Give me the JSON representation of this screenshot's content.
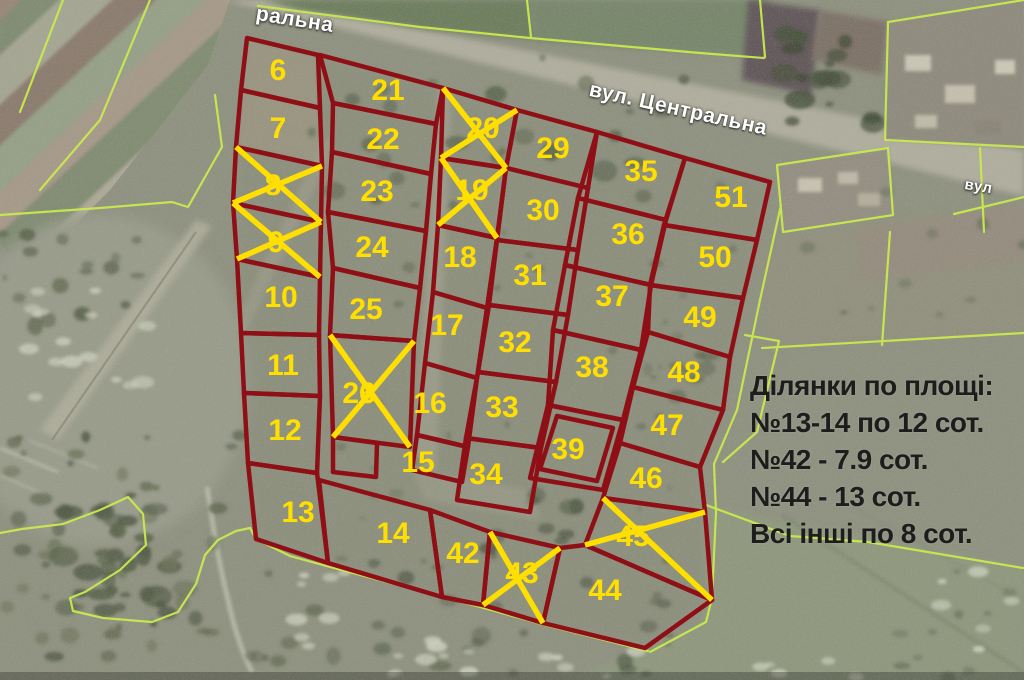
{
  "title": "Кадастровий план ділянок на супутниковому знімку",
  "colors": {
    "parcel_border": "#8e1016",
    "parcel_number": "#ffdf00",
    "sold_cross": "#ffdf00",
    "cadastral_line": "#c9e94f",
    "legend_text": "#1d1d1d",
    "street_label": "#ffffff"
  },
  "legend": {
    "title": "Ділянки по площі:",
    "lines": [
      "№13-14 по 12 сот.",
      "№42 - 7.9 сот.",
      "№44 - 13 сот.",
      "Всі інші по 8 сот."
    ]
  },
  "street_labels": {
    "central_full": "вул. Центральна",
    "central_partial_top": "ральна",
    "street_partial_right": "вул"
  },
  "sold_parcel_numbers": [
    "8",
    "9",
    "19",
    "20",
    "26",
    "43",
    "45"
  ],
  "parcels": [
    {
      "number": "6",
      "sold": false,
      "points": [
        [
          247,
          38
        ],
        [
          318,
          55
        ],
        [
          320,
          108
        ],
        [
          241,
          90
        ]
      ],
      "label": [
        278,
        70
      ]
    },
    {
      "number": "7",
      "sold": false,
      "points": [
        [
          241,
          90
        ],
        [
          320,
          108
        ],
        [
          322,
          166
        ],
        [
          236,
          147
        ]
      ],
      "label": [
        278,
        128
      ]
    },
    {
      "number": "8",
      "sold": true,
      "points": [
        [
          236,
          147
        ],
        [
          322,
          166
        ],
        [
          321,
          222
        ],
        [
          233,
          203
        ]
      ],
      "label": [
        273,
        185
      ]
    },
    {
      "number": "9",
      "sold": true,
      "points": [
        [
          233,
          203
        ],
        [
          321,
          222
        ],
        [
          320,
          277
        ],
        [
          237,
          259
        ]
      ],
      "label": [
        276,
        242
      ]
    },
    {
      "number": "10",
      "sold": false,
      "points": [
        [
          237,
          259
        ],
        [
          320,
          277
        ],
        [
          319,
          335
        ],
        [
          241,
          333
        ]
      ],
      "label": [
        281,
        297
      ]
    },
    {
      "number": "11",
      "sold": false,
      "points": [
        [
          241,
          333
        ],
        [
          319,
          335
        ],
        [
          320,
          396
        ],
        [
          244,
          393
        ]
      ],
      "label": [
        283,
        365
      ]
    },
    {
      "number": "12",
      "sold": false,
      "points": [
        [
          244,
          393
        ],
        [
          320,
          396
        ],
        [
          317,
          473
        ],
        [
          248,
          463
        ]
      ],
      "label": [
        285,
        430
      ]
    },
    {
      "number": "13",
      "sold": false,
      "points": [
        [
          248,
          463
        ],
        [
          317,
          473
        ],
        [
          328,
          563
        ],
        [
          256,
          539
        ]
      ],
      "label": [
        298,
        512
      ]
    },
    {
      "number": "21",
      "sold": false,
      "points": [
        [
          320,
          55
        ],
        [
          443,
          88
        ],
        [
          436,
          124
        ],
        [
          333,
          103
        ]
      ],
      "label": [
        388,
        90
      ]
    },
    {
      "number": "22",
      "sold": false,
      "points": [
        [
          333,
          103
        ],
        [
          436,
          124
        ],
        [
          431,
          174
        ],
        [
          332,
          152
        ]
      ],
      "label": [
        383,
        139
      ]
    },
    {
      "number": "23",
      "sold": false,
      "points": [
        [
          332,
          152
        ],
        [
          431,
          174
        ],
        [
          426,
          231
        ],
        [
          328,
          212
        ]
      ],
      "label": [
        377,
        191
      ]
    },
    {
      "number": "24",
      "sold": false,
      "points": [
        [
          328,
          212
        ],
        [
          426,
          231
        ],
        [
          420,
          288
        ],
        [
          333,
          268
        ]
      ],
      "label": [
        372,
        247
      ]
    },
    {
      "number": "25",
      "sold": false,
      "points": [
        [
          333,
          268
        ],
        [
          420,
          288
        ],
        [
          414,
          341
        ],
        [
          330,
          335
        ]
      ],
      "label": [
        366,
        309
      ]
    },
    {
      "number": "26",
      "sold": true,
      "points": [
        [
          330,
          335
        ],
        [
          414,
          341
        ],
        [
          410,
          447
        ],
        [
          333,
          437
        ]
      ],
      "label": [
        359,
        393
      ]
    },
    {
      "number": "",
      "sold": false,
      "points": [
        [
          333,
          437
        ],
        [
          377,
          443
        ],
        [
          376,
          477
        ],
        [
          333,
          472
        ]
      ],
      "label": null
    },
    {
      "number": "14",
      "sold": false,
      "points": [
        [
          319,
          480
        ],
        [
          430,
          510
        ],
        [
          442,
          597
        ],
        [
          328,
          563
        ]
      ],
      "label": [
        393,
        533
      ]
    },
    {
      "number": "20",
      "sold": true,
      "points": [
        [
          443,
          88
        ],
        [
          517,
          110
        ],
        [
          506,
          168
        ],
        [
          441,
          158
        ]
      ],
      "label": [
        483,
        128
      ]
    },
    {
      "number": "19",
      "sold": true,
      "points": [
        [
          441,
          158
        ],
        [
          506,
          168
        ],
        [
          497,
          238
        ],
        [
          438,
          225
        ]
      ],
      "label": [
        472,
        190
      ]
    },
    {
      "number": "18",
      "sold": false,
      "points": [
        [
          438,
          225
        ],
        [
          497,
          238
        ],
        [
          487,
          308
        ],
        [
          433,
          292
        ]
      ],
      "label": [
        460,
        257
      ]
    },
    {
      "number": "17",
      "sold": false,
      "points": [
        [
          433,
          292
        ],
        [
          487,
          308
        ],
        [
          477,
          378
        ],
        [
          425,
          363
        ]
      ],
      "label": [
        447,
        325
      ]
    },
    {
      "number": "16",
      "sold": false,
      "points": [
        [
          425,
          363
        ],
        [
          477,
          378
        ],
        [
          468,
          447
        ],
        [
          417,
          435
        ]
      ],
      "label": [
        430,
        403
      ]
    },
    {
      "number": "15",
      "sold": false,
      "points": [
        [
          417,
          435
        ],
        [
          468,
          447
        ],
        [
          462,
          482
        ],
        [
          412,
          470
        ]
      ],
      "label": [
        418,
        462
      ]
    },
    {
      "number": "42",
      "sold": false,
      "points": [
        [
          430,
          510
        ],
        [
          490,
          532
        ],
        [
          483,
          605
        ],
        [
          442,
          597
        ]
      ],
      "label": [
        463,
        553
      ]
    },
    {
      "number": "43",
      "sold": true,
      "points": [
        [
          490,
          532
        ],
        [
          560,
          548
        ],
        [
          543,
          623
        ],
        [
          483,
          605
        ]
      ],
      "label": [
        522,
        573
      ]
    },
    {
      "number": "29",
      "sold": false,
      "points": [
        [
          517,
          110
        ],
        [
          597,
          132
        ],
        [
          588,
          188
        ],
        [
          506,
          168
        ]
      ],
      "label": [
        553,
        148
      ]
    },
    {
      "number": "30",
      "sold": false,
      "points": [
        [
          506,
          168
        ],
        [
          588,
          188
        ],
        [
          578,
          250
        ],
        [
          497,
          240
        ]
      ],
      "label": [
        543,
        210
      ]
    },
    {
      "number": "31",
      "sold": false,
      "points": [
        [
          497,
          240
        ],
        [
          578,
          250
        ],
        [
          568,
          315
        ],
        [
          489,
          305
        ]
      ],
      "label": [
        530,
        275
      ]
    },
    {
      "number": "32",
      "sold": false,
      "points": [
        [
          489,
          305
        ],
        [
          568,
          315
        ],
        [
          556,
          382
        ],
        [
          478,
          372
        ]
      ],
      "label": [
        515,
        342
      ]
    },
    {
      "number": "33",
      "sold": false,
      "points": [
        [
          478,
          372
        ],
        [
          556,
          382
        ],
        [
          541,
          448
        ],
        [
          466,
          438
        ]
      ],
      "label": [
        502,
        407
      ]
    },
    {
      "number": "34",
      "sold": false,
      "points": [
        [
          466,
          438
        ],
        [
          541,
          448
        ],
        [
          530,
          512
        ],
        [
          457,
          500
        ]
      ],
      "label": [
        486,
        474
      ]
    },
    {
      "number": "44",
      "sold": false,
      "points": [
        [
          560,
          548
        ],
        [
          585,
          545
        ],
        [
          712,
          600
        ],
        [
          645,
          648
        ],
        [
          543,
          623
        ]
      ],
      "label": [
        605,
        590
      ]
    },
    {
      "number": "35",
      "sold": false,
      "points": [
        [
          597,
          132
        ],
        [
          685,
          158
        ],
        [
          666,
          220
        ],
        [
          578,
          198
        ]
      ],
      "label": [
        641,
        171
      ]
    },
    {
      "number": "36",
      "sold": false,
      "points": [
        [
          578,
          198
        ],
        [
          666,
          220
        ],
        [
          651,
          285
        ],
        [
          565,
          265
        ]
      ],
      "label": [
        628,
        234
      ]
    },
    {
      "number": "37",
      "sold": false,
      "points": [
        [
          565,
          265
        ],
        [
          651,
          285
        ],
        [
          641,
          350
        ],
        [
          553,
          330
        ]
      ],
      "label": [
        612,
        296
      ]
    },
    {
      "number": "38",
      "sold": false,
      "points": [
        [
          553,
          330
        ],
        [
          641,
          350
        ],
        [
          623,
          420
        ],
        [
          548,
          405
        ]
      ],
      "label": [
        592,
        367
      ]
    },
    {
      "number": "39",
      "sold": false,
      "points": [
        [
          548,
          405
        ],
        [
          623,
          420
        ],
        [
          603,
          490
        ],
        [
          530,
          478
        ]
      ],
      "label": [
        568,
        449
      ]
    },
    {
      "number": "",
      "sold": false,
      "points": [
        [
          557,
          416
        ],
        [
          613,
          428
        ],
        [
          597,
          481
        ],
        [
          540,
          469
        ]
      ],
      "label": null
    },
    {
      "number": "51",
      "sold": false,
      "points": [
        [
          685,
          158
        ],
        [
          770,
          182
        ],
        [
          757,
          240
        ],
        [
          664,
          225
        ]
      ],
      "label": [
        731,
        197
      ]
    },
    {
      "number": "50",
      "sold": false,
      "points": [
        [
          664,
          225
        ],
        [
          757,
          240
        ],
        [
          743,
          298
        ],
        [
          650,
          285
        ]
      ],
      "label": [
        715,
        257
      ]
    },
    {
      "number": "49",
      "sold": false,
      "points": [
        [
          650,
          285
        ],
        [
          743,
          298
        ],
        [
          730,
          357
        ],
        [
          648,
          332
        ]
      ],
      "label": [
        700,
        317
      ]
    },
    {
      "number": "48",
      "sold": false,
      "points": [
        [
          648,
          332
        ],
        [
          730,
          357
        ],
        [
          723,
          410
        ],
        [
          633,
          387
        ]
      ],
      "label": [
        684,
        372
      ]
    },
    {
      "number": "47",
      "sold": false,
      "points": [
        [
          633,
          387
        ],
        [
          723,
          410
        ],
        [
          700,
          467
        ],
        [
          620,
          443
        ]
      ],
      "label": [
        667,
        425
      ]
    },
    {
      "number": "46",
      "sold": false,
      "points": [
        [
          620,
          443
        ],
        [
          700,
          467
        ],
        [
          705,
          512
        ],
        [
          603,
          498
        ]
      ],
      "label": [
        646,
        478
      ]
    },
    {
      "number": "45",
      "sold": true,
      "points": [
        [
          603,
          498
        ],
        [
          705,
          512
        ],
        [
          712,
          600
        ],
        [
          585,
          545
        ]
      ],
      "label": [
        633,
        536
      ]
    }
  ]
}
